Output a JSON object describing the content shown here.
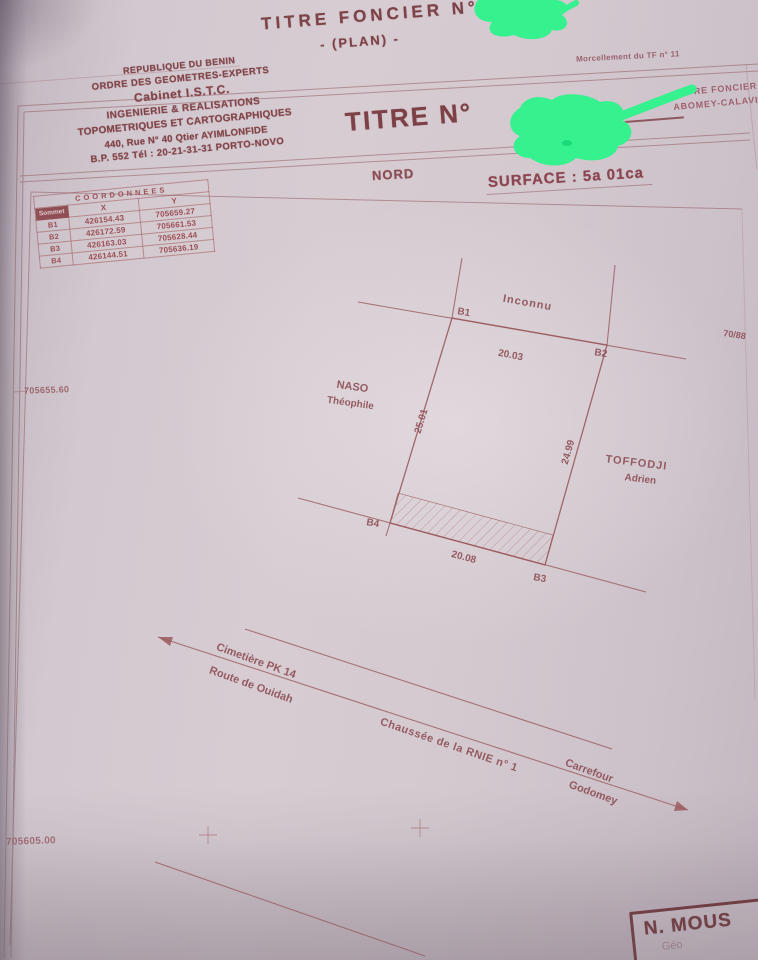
{
  "top_sheet": {
    "title": "TITRE FONCIER N°",
    "subtitle": "- (PLAN) -",
    "corner_note": "Morcellement du TF n° 11"
  },
  "letterhead": {
    "line1": "REPUBLIQUE DU BENIN",
    "line2": "ORDRE DES GEOMETRES-EXPERTS",
    "line3": "Cabinet I.S.T.C.",
    "line4": "INGENIERIE & REALISATIONS",
    "line5": "TOPOMETRIQUES ET CARTOGRAPHIQUES",
    "line6": "440, Rue N° 40 Qtier AYIMLONFIDE",
    "line7": "B.P. 552 Tél : 20-21-31-31 PORTO-NOVO"
  },
  "title_block": {
    "label": "TITRE N°",
    "registry_line1": "LIVRE FONCIER",
    "registry_line2": "ABOMEY-CALAVI"
  },
  "plan_header": {
    "north": "NORD",
    "surface": "SURFACE : 5a 01ca"
  },
  "coordinates_table": {
    "title": "COORDONNEES",
    "col_point": "Sommet",
    "col_x": "X",
    "col_y": "Y",
    "rows": [
      {
        "id": "B1",
        "x": "426154.43",
        "y": "705659.27"
      },
      {
        "id": "B2",
        "x": "426172.59",
        "y": "705661.53"
      },
      {
        "id": "B3",
        "x": "426163.03",
        "y": "705628.44"
      },
      {
        "id": "B4",
        "x": "426144.51",
        "y": "705636.19"
      }
    ]
  },
  "margin_labels": {
    "left_upper": "705655.60",
    "left_lower": "705605.00",
    "right_edge": "70/88"
  },
  "parcel": {
    "corner_b1": "B1",
    "corner_b2": "B2",
    "corner_b3": "B3",
    "corner_b4": "B4",
    "side_top": "20.03",
    "side_left": "25.01",
    "side_right": "24.99",
    "side_bottom": "20.08",
    "neighbor_north": "Inconnu",
    "neighbor_west_line1": "NASO",
    "neighbor_west_line2": "Théophile",
    "neighbor_east_line1": "TOFFODJI",
    "neighbor_east_line2": "Adrien"
  },
  "roads": {
    "dest_left_line1": "Cimetière PK 14",
    "dest_left_line2": "Route de Ouidah",
    "name": "Chaussée de la  RNIE n° 1",
    "dest_right_line1": "Carrefour",
    "dest_right_line2": "Godomey"
  },
  "stamp": {
    "line1": "N. MOUS",
    "line2": "Géo"
  },
  "colors": {
    "ink": "#82454a",
    "highlight": "#35f18e",
    "paper": "#d3c9cf"
  }
}
